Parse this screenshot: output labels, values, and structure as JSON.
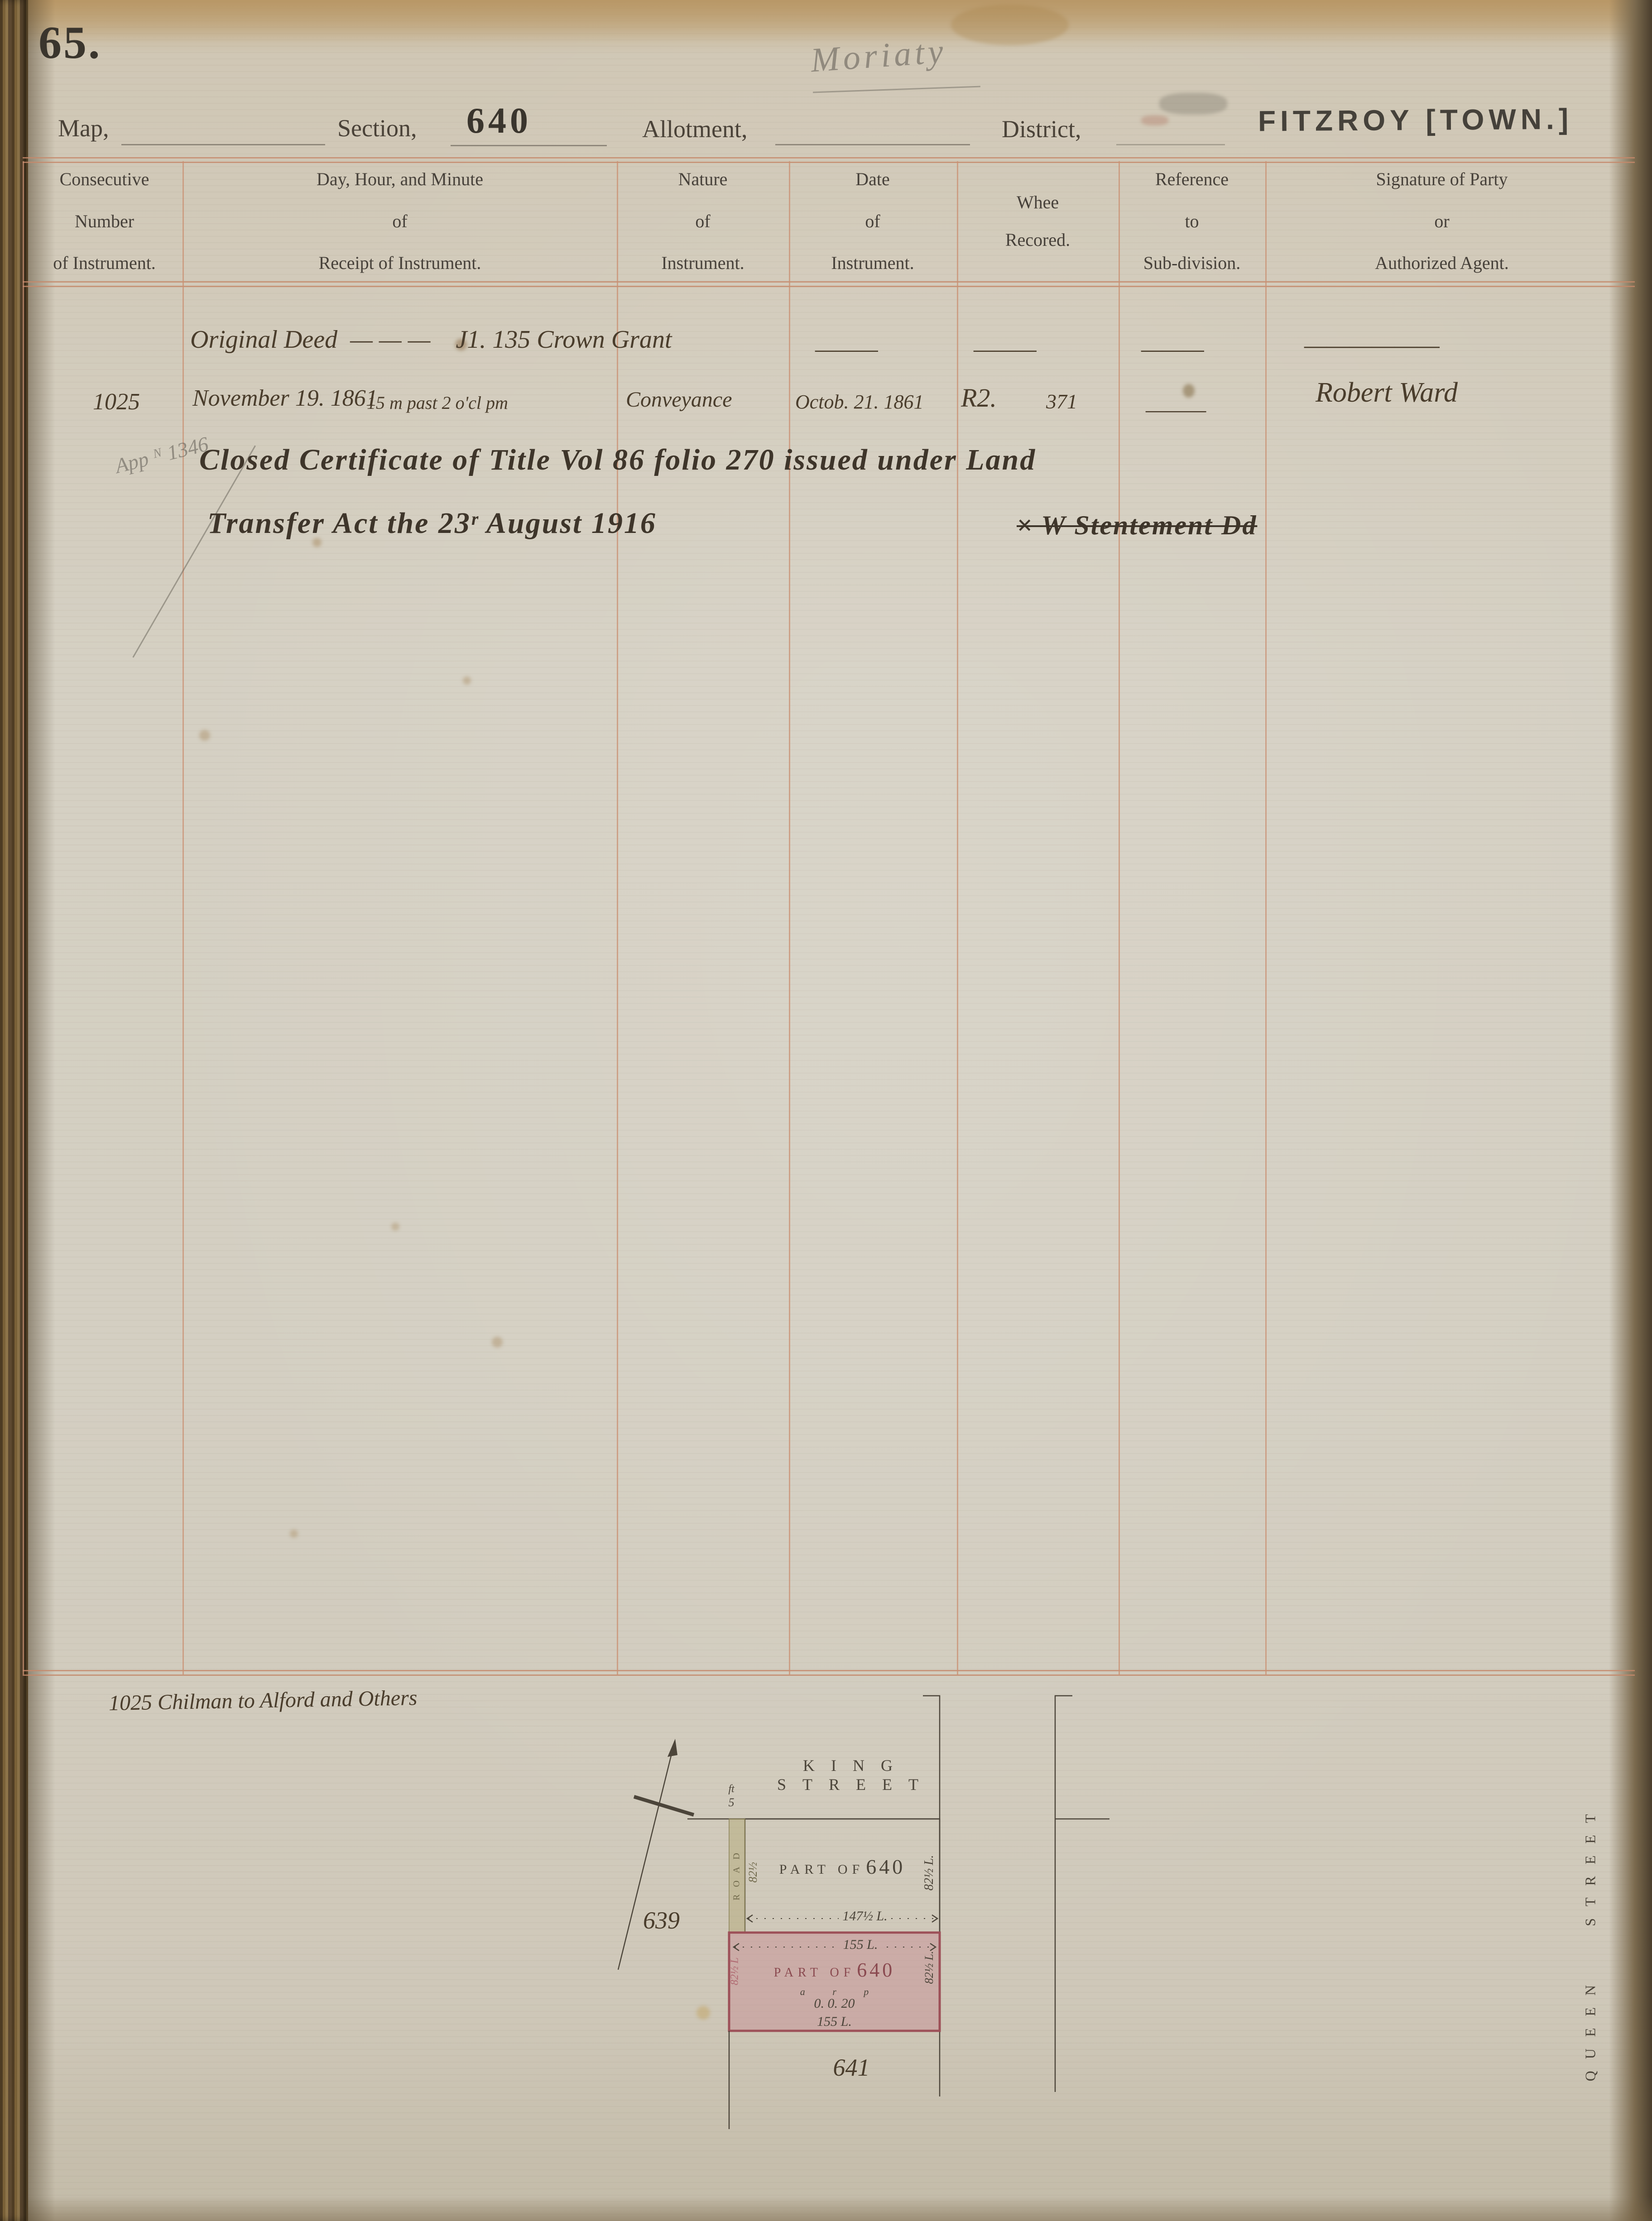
{
  "page": {
    "number": "65.",
    "pencil_annotation": "Moriaty"
  },
  "header": {
    "map_label": "Map,",
    "section_label": "Section,",
    "section_value": "640",
    "allotment_label": "Allotment,",
    "district_label": "District,",
    "district_value": "FITZROY [TOWN.]"
  },
  "table": {
    "columns": [
      {
        "lines": [
          "Consecutive",
          "Number",
          "of Instrument."
        ]
      },
      {
        "lines": [
          "Day, Hour, and Minute",
          "of",
          "Receipt of Instrument."
        ]
      },
      {
        "lines": [
          "Nature",
          "of",
          "Instrument."
        ]
      },
      {
        "lines": [
          "Date",
          "of",
          "Instrument."
        ]
      },
      {
        "lines": [
          "Whee",
          "Recored."
        ]
      },
      {
        "lines": [
          "Reference",
          "to",
          "Sub-division."
        ]
      },
      {
        "lines": [
          "Signature of Party",
          "or",
          "Authorized Agent."
        ]
      }
    ]
  },
  "entries": {
    "row1": {
      "text": "Original Deed  — — —    J1. 135 Crown Grant",
      "date": "———",
      "recorded": "———",
      "reference": "———",
      "signature": "——————"
    },
    "row2": {
      "number": "1025",
      "receipt_date": "November 19. 1861",
      "receipt_time": "15 m past 2 o'cl pm",
      "nature": "Conveyance",
      "date": "Octob. 21. 1861",
      "recorded_book": "R2.",
      "recorded_folio": "371",
      "reference": "———",
      "signature": "Robert Ward"
    },
    "note": {
      "pencil_ref": "App ᴺ 1346",
      "line1": "Closed Certificate of Title Vol 86 folio 270 issued under Land",
      "line2": "Transfer Act the 23ʳ August 1916",
      "cancelled_sig": "× W Stentement Dd"
    }
  },
  "footer": {
    "note": "1025 Chilman to Alford and Others"
  },
  "plan": {
    "king_street": "KING STREET",
    "queen_street": "QUEEN STREET",
    "road_label": "ROAD",
    "road_width_unit": "ft",
    "road_width_value": "5",
    "upper_parcel_prefix": "PART OF",
    "upper_parcel_number": "640",
    "upper_dim_left": "82½",
    "upper_dim_right": "82½ L.",
    "upper_dim_bottom": "147½ L.",
    "adjacent_section_left": "639",
    "adjacent_section_below": "641",
    "pink_parcel_prefix": "PART OF",
    "pink_parcel_number": "640",
    "pink_area_units": "a r p",
    "pink_area_value": "0. 0. 20",
    "pink_dim_top": "155 L.",
    "pink_dim_bottom": "155 L.",
    "pink_dim_left": "82½ L",
    "pink_dim_right": "82½ L."
  },
  "colors": {
    "rule": "#c08a6a",
    "ink": "#42382c",
    "pencil": "#8d8579",
    "parcel_pink": "#c77f8a",
    "road_strip": "#b5ad79",
    "stamp": "#474239"
  }
}
